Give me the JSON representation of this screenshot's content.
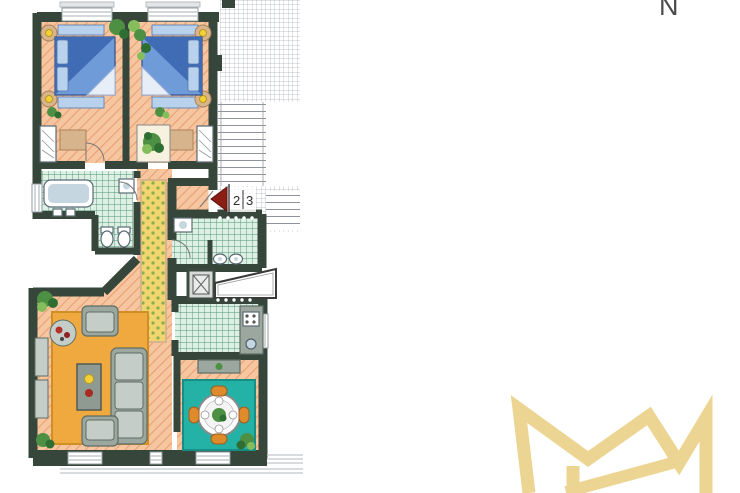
{
  "compass": {
    "label": "N"
  },
  "floor_plan": {
    "unit_marker": {
      "number_left": "2",
      "number_right": "3"
    }
  },
  "logo": {
    "monogram": "MW"
  },
  "colors": {
    "wall": "#36463b",
    "floor": "#f6c6a0",
    "floorLine": "#e99e72",
    "tile": "#def0e4",
    "tileLine": "#4d9674",
    "hatchLine": "#abb1bd",
    "stairLine": "#8e939d",
    "runner": "#f0d570",
    "runnerDot": "#8aae4a",
    "rugOrange": "#f0a93e",
    "rugTeal": "#25b2a6",
    "bedBlue": "#6f9cd8",
    "bedDark": "#3f6cb5",
    "bedLight": "#b8d2ee",
    "furnGray": "#9ba79f",
    "furnDark": "#5f6d66",
    "tan": "#d8b48c",
    "lamp": "#f3cf3a",
    "plant": "#4e9043",
    "plantDark": "#2f6e33",
    "marker": "#8a1d14",
    "gold": "#ecd592",
    "winframe": "#8f989d"
  }
}
